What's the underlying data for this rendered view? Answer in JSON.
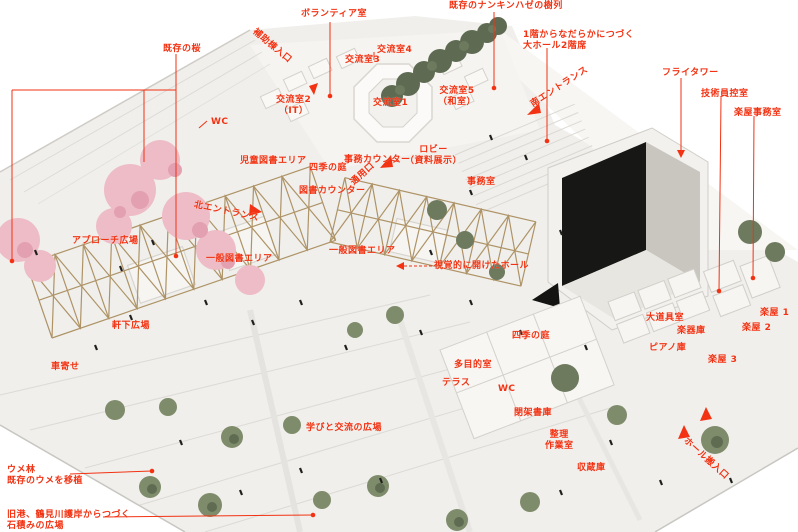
{
  "image_type": "aerial photo of white architectural site model annotated with red Japanese labels",
  "colors": {
    "annotation_red": "#f23212",
    "model_ground": "#f0efec",
    "cherry_pink": "#eebcc6",
    "tree_green": "#67745a",
    "timber_tan": "#a78a58",
    "void_black": "#171715"
  },
  "labels": {
    "existing_cherry": "既存の桜",
    "volunteer_room": "ボランティア室",
    "aux_entrance": "補助棟入口",
    "nankin_row": "既存のナンキンハゼの樹列",
    "koryu_room_4": "交流室4",
    "koryu_room_3": "交流室3",
    "koryu_room_2": "交流室2\n（IT）",
    "koryu_room_1": "交流室1",
    "koryu_room_5": "交流室5\n（和室）",
    "hall_2f_seats": "1階からなだらかにつづく\n大ホール2階席",
    "south_entrance": "南エントランス",
    "fly_tower": "フライタワー",
    "tech_staff_room": "技術員控室",
    "gakuya_office": "楽屋事務室",
    "wc_1": "WC",
    "service_door": "通用口",
    "office": "事務室",
    "office_counter": "事務カウンター",
    "children_book_area": "児童図書エリア",
    "four_seasons_garden_1": "四季の庭",
    "book_counter": "図書カウンター",
    "lobby": "ロビー\n（資料展示）",
    "north_entrance": "北エントランス",
    "general_book_area_left": "一般図書エリア",
    "general_book_area_right": "一般図書エリア",
    "visually_open_hall": "視覚的に開けたホール",
    "approach_plaza": "アプローチ広場",
    "under_eaves_plaza": "軒下広場",
    "car_dropoff": "車寄せ",
    "props_room": "大道具室",
    "instrument_storage": "楽器庫",
    "piano_storage": "ピアノ庫",
    "gakuya_1": "楽屋 1",
    "gakuya_2": "楽屋 2",
    "gakuya_3": "楽屋 3",
    "four_seasons_garden_2": "四季の庭",
    "multipurpose_room": "多目的室",
    "terrace": "テラス",
    "wc_2": "WC",
    "closed_stacks": "閉架書庫",
    "sorting_workroom": "整理\n作業室",
    "repository": "収蔵庫",
    "learning_exchange_plaza": "学びと交流の広場",
    "ume_grove": "ウメ林\n既存のウメを移植",
    "stone_plaza": "旧港、鶴見川護岸からつづく\n石積みの広場",
    "hall_loading": "ホール搬入口"
  }
}
